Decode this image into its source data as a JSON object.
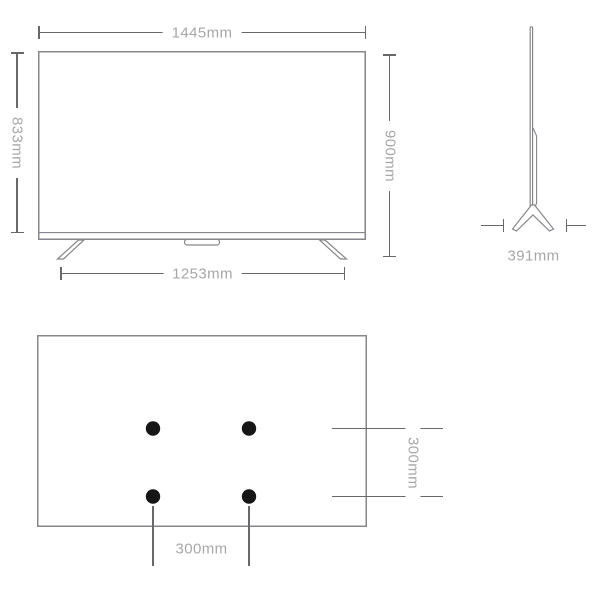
{
  "colors": {
    "background": "#ffffff",
    "outline": "#86878b",
    "dim_line": "#68686c",
    "label_text": "#a7a7aa",
    "vesa_dot": "#161616"
  },
  "views": {
    "front": {
      "labels": {
        "overall_width": "1445mm",
        "panel_height": "833mm",
        "overall_height": "900mm",
        "stand_span": "1253mm"
      }
    },
    "side": {
      "labels": {
        "stand_depth": "391mm"
      }
    },
    "back": {
      "vesa_hole_count": 4,
      "labels": {
        "vesa_vertical": "300mm",
        "vesa_horizontal": "300mm"
      }
    }
  }
}
